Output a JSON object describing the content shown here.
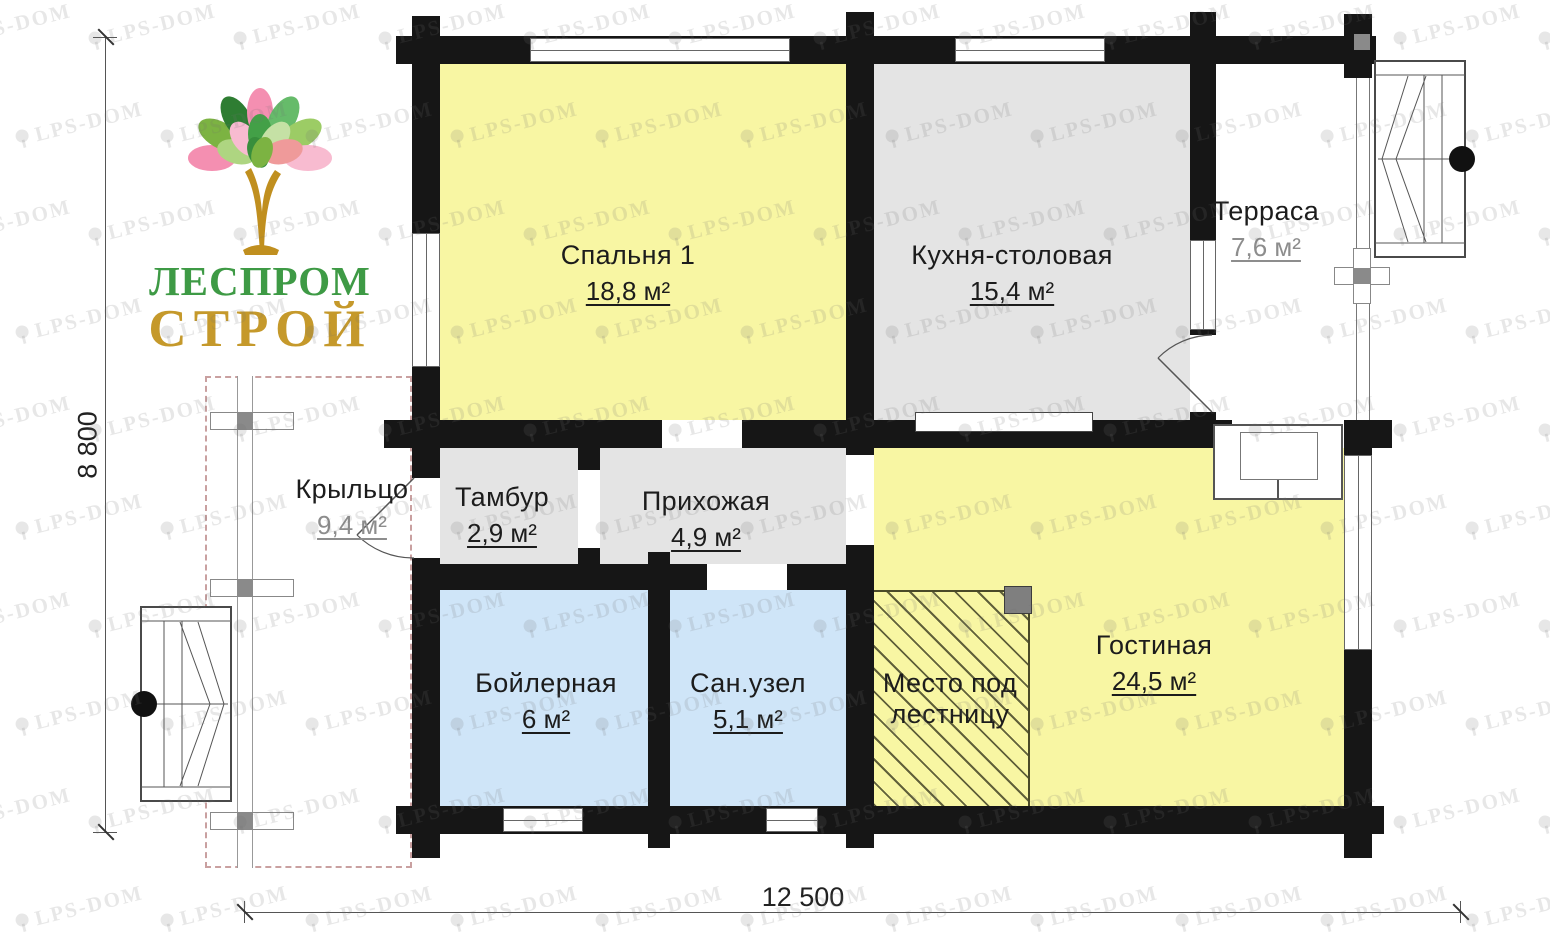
{
  "logo": {
    "line1": "ЛЕСПРОМ",
    "line2": "СТРОЙ",
    "color_line1": "#3e9a45",
    "color_line2": "#c5992b"
  },
  "watermark": {
    "text": "LPS-DOM"
  },
  "dimensions": {
    "height": "8 800",
    "width": "12 500"
  },
  "rooms": [
    {
      "key": "bedroom",
      "name": "Спальня 1",
      "area": "18,8 м²",
      "fill": "#f8f6a3"
    },
    {
      "key": "kitchen",
      "name": "Кухня-столовая",
      "area": "15,4 м²",
      "fill": "#e4e4e4"
    },
    {
      "key": "terrace",
      "name": "Терраса",
      "area": "7,6 м²",
      "fill": "#ffffff"
    },
    {
      "key": "porch",
      "name": "Крыльцо",
      "area": "9,4 м²",
      "fill": "#ffffff"
    },
    {
      "key": "tambour",
      "name": "Тамбур",
      "area": "2,9 м²",
      "fill": "#e4e4e4"
    },
    {
      "key": "hallway",
      "name": "Прихожая",
      "area": "4,9 м²",
      "fill": "#e4e4e4"
    },
    {
      "key": "boiler",
      "name": "Бойлерная",
      "area": "6 м²",
      "fill": "#cfe5f8"
    },
    {
      "key": "bathroom",
      "name": "Сан.узел",
      "area": "5,1 м²",
      "fill": "#cfe5f8"
    },
    {
      "key": "stairs_space",
      "name": "Место под",
      "name_line2": "лестницу",
      "fill": "#f8f6a3"
    },
    {
      "key": "living",
      "name": "Гостиная",
      "area": "24,5 м²",
      "fill": "#f8f6a3"
    }
  ],
  "colors": {
    "wall": "#161616",
    "hatch_line": "#4a4a28",
    "dash_outline": "#c9a0a0",
    "dimension": "#555555",
    "area_muted": "#8d8d8d"
  }
}
